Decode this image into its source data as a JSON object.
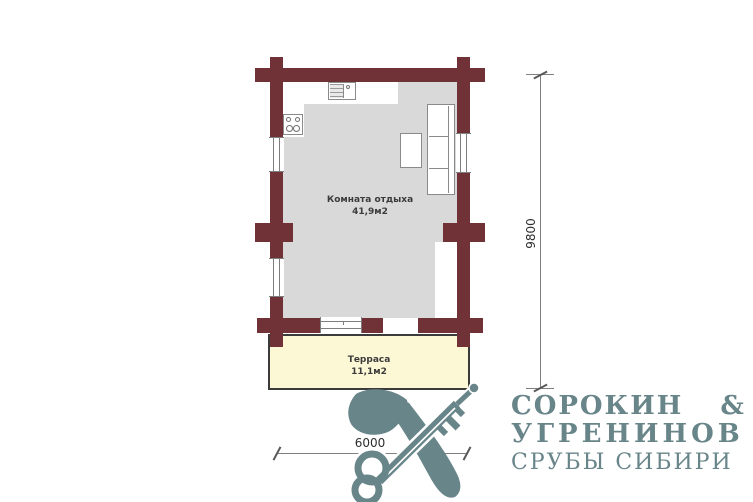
{
  "plan": {
    "room": {
      "label": "Комната отдыха",
      "area": "41,9м2"
    },
    "terrace": {
      "label": "Терраса",
      "area": "11,1м2"
    },
    "dimensions": {
      "height_mm": "9800",
      "width_mm": "6000"
    }
  },
  "logo": {
    "line1": "СОРОКИН &",
    "line2": "УГРЕНИНОВ",
    "line3": "СРУБЫ СИБИРИ"
  },
  "icons": {
    "emblem": "crossed-axe-and-key"
  },
  "colors": {
    "wall": "#703236",
    "floor": "#d9d9d9",
    "terr": "#fcf8d6",
    "terrb": "#3b3b3b",
    "furn": "#8a8a8a",
    "dim": "#808080",
    "lbl": "#3b3b3b",
    "logo": "#68858a"
  }
}
